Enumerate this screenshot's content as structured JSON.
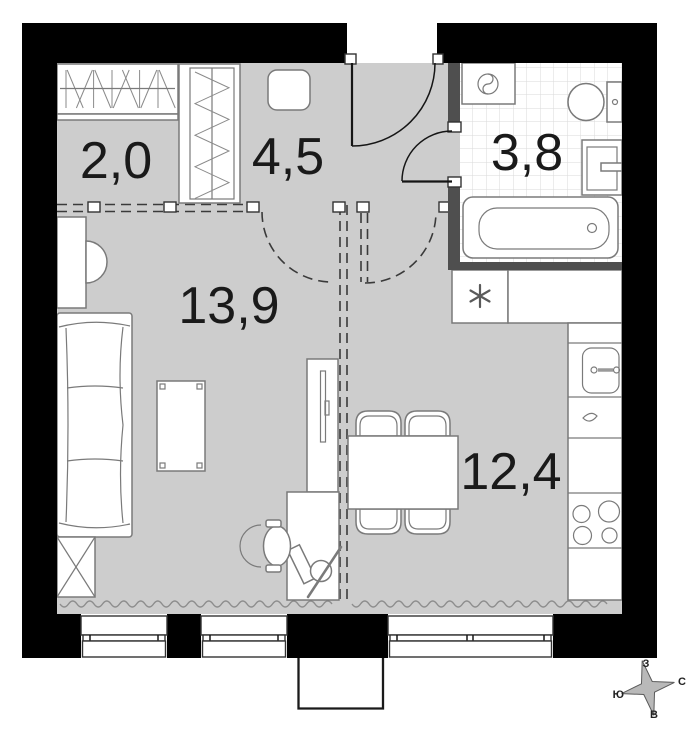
{
  "title": "Studio apartment floor plan",
  "rooms": [
    {
      "name": "closet",
      "area": "2,0"
    },
    {
      "name": "hallway",
      "area": "4,5"
    },
    {
      "name": "bathroom",
      "area": "3,8"
    },
    {
      "name": "living-room",
      "area": "13,9"
    },
    {
      "name": "kitchen",
      "area": "12,4"
    }
  ],
  "compass": {
    "north": "С",
    "south": "Ю",
    "west": "З",
    "east": "В"
  },
  "fixtures": [
    "wardrobe-hanging-icon",
    "wardrobe-tall-icon",
    "pouf-icon",
    "washing-machine-icon",
    "toilet-icon",
    "bathroom-sink-icon",
    "bathtub-icon",
    "appliance-asterisk-icon",
    "kitchen-sink-icon",
    "stove-burners-icon",
    "dining-table-icon",
    "chair-icon",
    "sofa-icon",
    "side-table-icon",
    "coffee-table-icon",
    "tv-unit-icon",
    "desk-icon",
    "office-chair-icon",
    "window-icon",
    "balcony-icon",
    "door-swing-icon",
    "curtain-wave-icon"
  ],
  "colors": {
    "wall": "#000000",
    "partition": "#4f4f4f",
    "floor": "#cdcdcd",
    "outline": "#7a7a7a",
    "label": "#1a1a1a",
    "tile": "#dadada",
    "dash": "#3a3a3a",
    "compass": "#b9b9b9"
  }
}
